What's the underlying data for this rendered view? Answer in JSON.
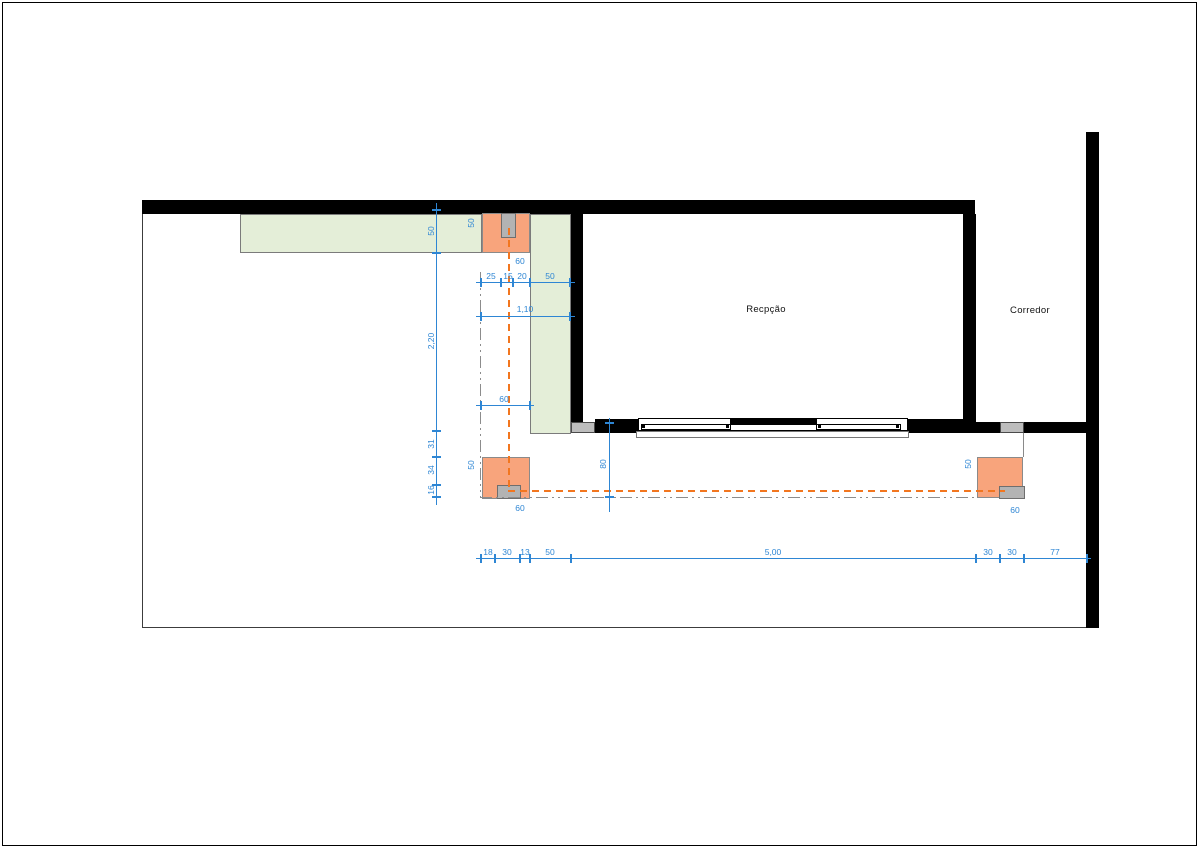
{
  "drawing": {
    "rooms": {
      "reception": "Recpção",
      "corridor": "Corredor"
    },
    "dims": {
      "left_chain": [
        "50",
        "2,20",
        "31",
        "34",
        "16"
      ],
      "top_column": {
        "height": "50",
        "width": "60"
      },
      "upper_chain": [
        "25",
        "15",
        "20",
        "50"
      ],
      "opening_width": "1,10",
      "mid_width": "60",
      "gap_height": "80",
      "col_bottom_left": {
        "height": "50",
        "width": "60"
      },
      "col_bottom_right": {
        "height": "50",
        "width": "60"
      },
      "bottom_chain": [
        "18",
        "30",
        "13",
        "50",
        "5,00",
        "30",
        "30",
        "77"
      ]
    },
    "colors": {
      "wall": "#000000",
      "column_fill": "#f8a47c",
      "green_fill": "#e4eed8",
      "dim_blue": "#2e86d4",
      "centerline_orange": "#f2761f",
      "phantom_gray": "#8c8c8c",
      "box_gray": "#bdbdbd"
    }
  }
}
